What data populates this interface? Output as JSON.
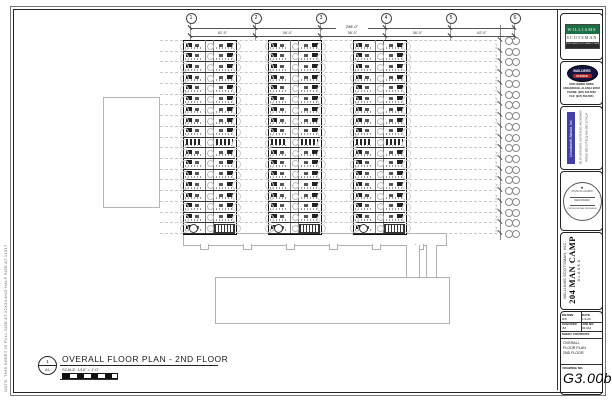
{
  "sheet": {
    "margin_note": "NOTE: THIS SHEET IS FULL SIZE AT 22X34 AND HALF SIZE AT 11X17",
    "footer": {
      "callout_top": "1",
      "callout_bottom": "A1",
      "title": "OVERALL FLOOR PLAN - 2ND FLOOR",
      "scale": "SCALE: 1/16\" = 1'-0\""
    }
  },
  "plan": {
    "grid_top": {
      "labels": [
        "1",
        "2",
        "3",
        "4",
        "5",
        "6"
      ],
      "overall_dim": "298'-0\"",
      "bay_dims": [
        "62'-0\"",
        "58'-0\"",
        "58'-0\"",
        "58'-0\"",
        "62'-0\""
      ]
    },
    "grid_side": {
      "bay_dim_typ": "11'-4\"",
      "rows": 19
    }
  },
  "titleblock": {
    "ws": {
      "line1": "WILLIAMS",
      "line2": "SCOTSMAN",
      "tagline": "A WILLIAMS SCOTSMAN COMPANY"
    },
    "builders": {
      "name1": "BUILDERS",
      "name2": "CHOICE",
      "addr": [
        "5400 HOMER DRIVE",
        "ANCHORAGE, ALASKA 99518",
        "PHONE: (907) 563-5050",
        "FAX: (907) 563-5051"
      ]
    },
    "woodworth": {
      "banner": "Woodworth Alaska, Inc.",
      "addr1": "301 W. NORTHERN LIGHTS BLVD.  ANCHORAGE, ALASKA",
      "addr2": "PHONE: (907) 277-0123   FAX: (907) 277-0124"
    },
    "stamp": {
      "top": "STATE OF ALASKA",
      "mid": "REGISTERED",
      "bottom": "PROFESSIONAL ENGINEER"
    },
    "project": {
      "company": "WILLIAMS SCOTSMAN, INC.",
      "name": "204 MAN CAMP",
      "location": "ALASKA"
    },
    "info": {
      "drawn_label": "DRAWN",
      "drawn": "DW",
      "date_label": "DATE",
      "date": "1-9-06",
      "checked_label": "CHECKED",
      "checked": "JM",
      "job_label": "JOB NO.",
      "job": "06-014",
      "sheet_contents_label": "SHEET CONTENTS",
      "contents_line1": "OVERALL",
      "contents_line2": "FLOOR PLAN",
      "contents_line3": "2ND FLOOR",
      "drawing_no_label": "DRAWING NO.",
      "drawing_no": "G3.00b"
    }
  }
}
